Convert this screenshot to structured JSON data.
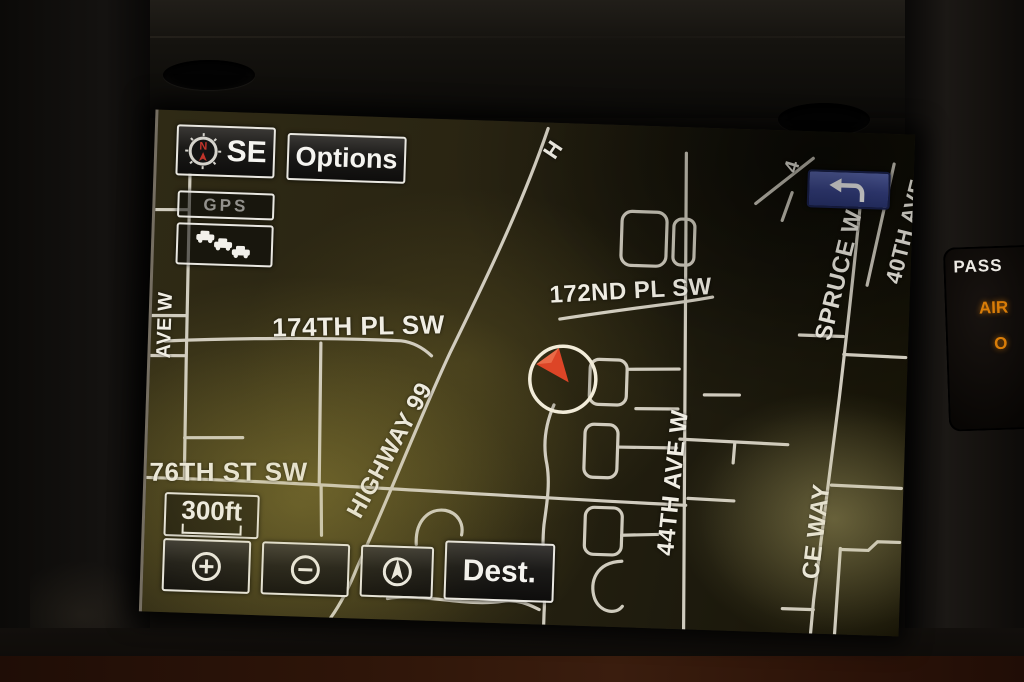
{
  "screen": {
    "compass": {
      "heading_label": "SE",
      "icon": "compass-n-icon"
    },
    "toolbar": {
      "options_label": "Options",
      "gps_label": "GPS",
      "traffic_icon": "traffic-cars-icon"
    },
    "return_button": {
      "icon": "u-turn-arrow-icon"
    },
    "scale": {
      "label": "300ft"
    },
    "bottom_bar": {
      "zoom_in_icon": "circle-plus-icon",
      "zoom_out_icon": "circle-minus-icon",
      "north_up_icon": "north-arrow-icon",
      "dest_label": "Dest."
    },
    "map": {
      "vehicle_marker": "circle with red heading wedge",
      "street_labels": [
        {
          "text": "H"
        },
        {
          "text": "172ND PL SW"
        },
        {
          "text": "174TH PL SW"
        },
        {
          "text": "HIGHWAY 99"
        },
        {
          "text": "76TH ST SW"
        },
        {
          "text": "44TH AVE W"
        },
        {
          "text": "SPRUCE W"
        },
        {
          "text": "CE WAY"
        },
        {
          "text": "40TH AVE"
        },
        {
          "text": "4"
        },
        {
          "text": "AVE W"
        }
      ]
    }
  },
  "dashboard": {
    "airbag_indicator": {
      "line1": "PASS",
      "line2": "AIR",
      "line3": "O"
    }
  },
  "colors": {
    "accent_blue": "#3f4e9f",
    "road": "#dad5c8",
    "marker_red": "#dd4527",
    "amber": "#d97d08",
    "screen_olive": "#2a2512"
  }
}
